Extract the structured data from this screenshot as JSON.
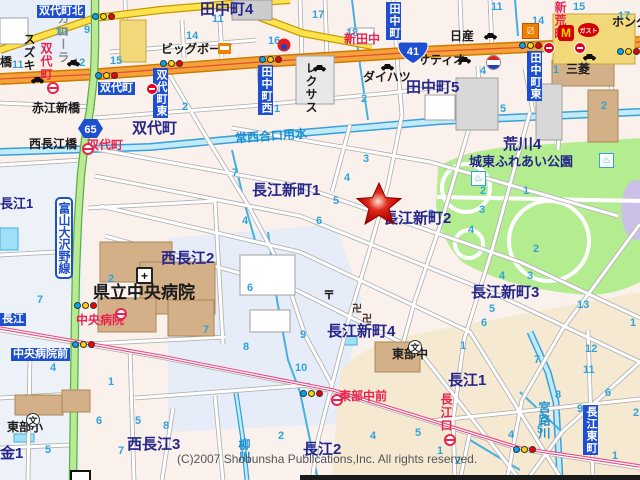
{
  "map": {
    "copyright": "(C)2007 Shobunsha Publications,Inc. All rights reserved.",
    "road_name_plate": "富山大沢野線",
    "route_shields": [
      {
        "number": "65",
        "type": "prefectural-road-hexagon"
      },
      {
        "number": "41",
        "type": "national-route-cartouche"
      }
    ],
    "marker": {
      "name": "destination-star",
      "color": "#cc1111"
    },
    "colors": {
      "district_label": "#26268a",
      "sign_blue": "#1e4fd0",
      "bus_red": "#e8244f",
      "water_blue": "#1d8fd0",
      "block_number": "#2fa3dc",
      "road_national": "#f6a23c",
      "road_pref": "#b9ea96",
      "road_minor_yellow": "#ffe34d",
      "park": "#b4ec90",
      "tram": "#e8487f"
    },
    "glyphs": {
      "school": "文",
      "post_office": "〒",
      "temple": "卍",
      "onsen": "♨",
      "mcdonalds": "M",
      "gusto_text": "ガスト"
    },
    "labels": {
      "districts": [
        {
          "t": "田中町4",
          "x": 200,
          "y": 2,
          "big": 1
        },
        {
          "t": "田中町5",
          "x": 406,
          "y": 80,
          "big": 1
        },
        {
          "t": "双代町",
          "x": 132,
          "y": 121,
          "big": 1
        },
        {
          "t": "荒川4",
          "x": 503,
          "y": 137,
          "big": 1
        },
        {
          "t": "城東ふれあい公園",
          "x": 469,
          "y": 155
        },
        {
          "t": "長江新町1",
          "x": 252,
          "y": 183,
          "big": 1
        },
        {
          "t": "長江新町2",
          "x": 383,
          "y": 211,
          "big": 1
        },
        {
          "t": "長江新町3",
          "x": 471,
          "y": 285,
          "big": 1
        },
        {
          "t": "長江新町4",
          "x": 327,
          "y": 324,
          "big": 1
        },
        {
          "t": "長江1",
          "x": 448,
          "y": 373,
          "big": 1
        },
        {
          "t": "長江1",
          "x": 0,
          "y": 197
        },
        {
          "t": "長江2",
          "x": 303,
          "y": 442,
          "big": 1
        },
        {
          "t": "西長江2",
          "x": 161,
          "y": 251,
          "big": 1
        },
        {
          "t": "西長江3",
          "x": 127,
          "y": 437,
          "big": 1
        },
        {
          "t": "金1",
          "x": 0,
          "y": 446,
          "big": 1
        }
      ],
      "blue_signs": [
        {
          "t": "双代町北",
          "x": 37,
          "y": 5
        },
        {
          "t": "双代町",
          "x": 98,
          "y": 82
        },
        {
          "t": "中央病院前",
          "x": 11,
          "y": 348
        },
        {
          "t": "長江",
          "x": 0,
          "y": 313
        },
        {
          "t": "双代町東",
          "x": 153,
          "y": 68,
          "v": 1
        },
        {
          "t": "田中町西",
          "x": 258,
          "y": 65,
          "v": 1
        },
        {
          "t": "田中町",
          "x": 386,
          "y": 2,
          "v": 1
        },
        {
          "t": "田中町東",
          "x": 527,
          "y": 51,
          "v": 1
        },
        {
          "t": "長江東町",
          "x": 583,
          "y": 405,
          "v": 1
        }
      ],
      "red_stops": [
        {
          "t": "新田中",
          "x": 344,
          "y": 33
        },
        {
          "t": "新荒町",
          "x": 554,
          "y": 1,
          "v": 1
        },
        {
          "t": "双代町",
          "x": 40,
          "y": 42,
          "v": 1
        },
        {
          "t": "双代町",
          "x": 87,
          "y": 139
        },
        {
          "t": "中央病院",
          "x": 76,
          "y": 314
        },
        {
          "t": "東部中前",
          "x": 339,
          "y": 390
        },
        {
          "t": "長江口",
          "x": 440,
          "y": 393,
          "v": 1
        }
      ],
      "facilities": [
        {
          "t": "スズキ",
          "x": 23,
          "y": 33,
          "v": 1
        },
        {
          "t": "カローラ",
          "x": 57,
          "y": 12,
          "v": 1,
          "gray": 1
        },
        {
          "t": "橋",
          "x": 0,
          "y": 56
        },
        {
          "t": "赤江新橋",
          "x": 32,
          "y": 102
        },
        {
          "t": "西長江橋",
          "x": 29,
          "y": 138
        },
        {
          "t": "ビッグボーイ",
          "x": 161,
          "y": 43
        },
        {
          "t": "レクサス",
          "x": 305,
          "y": 62,
          "v": 1
        },
        {
          "t": "ダイハツ",
          "x": 363,
          "y": 71
        },
        {
          "t": "日産",
          "x": 450,
          "y": 30
        },
        {
          "t": "サティオ",
          "x": 418,
          "y": 54
        },
        {
          "t": "三菱",
          "x": 566,
          "y": 63
        },
        {
          "t": "ホンダ",
          "x": 612,
          "y": 16
        },
        {
          "t": "県立中央病院",
          "x": 93,
          "y": 284,
          "big": 1
        },
        {
          "t": "東部小",
          "x": 7,
          "y": 421
        },
        {
          "t": "東部中",
          "x": 392,
          "y": 348
        }
      ],
      "water": [
        {
          "t": "常西合口用水",
          "x": 235,
          "y": 130,
          "rot": -4
        },
        {
          "t": "宮路川",
          "x": 538,
          "y": 401,
          "v": 1
        },
        {
          "t": "柳川",
          "x": 238,
          "y": 438,
          "v": 1
        }
      ],
      "block_numbers": [
        {
          "t": "10",
          "x": 55,
          "y": 27
        },
        {
          "t": "9",
          "x": 84,
          "y": 25
        },
        {
          "t": "11",
          "x": 12,
          "y": 60
        },
        {
          "t": "12",
          "x": 73,
          "y": 58
        },
        {
          "t": "15",
          "x": 110,
          "y": 56
        },
        {
          "t": "14",
          "x": 186,
          "y": 31
        },
        {
          "t": "2",
          "x": 182,
          "y": 102
        },
        {
          "t": "11",
          "x": 212,
          "y": 14
        },
        {
          "t": "16",
          "x": 268,
          "y": 36
        },
        {
          "t": "17",
          "x": 312,
          "y": 10
        },
        {
          "t": "18",
          "x": 346,
          "y": 28
        },
        {
          "t": "2",
          "x": 361,
          "y": 94
        },
        {
          "t": "1",
          "x": 274,
          "y": 104
        },
        {
          "t": "11",
          "x": 491,
          "y": 2
        },
        {
          "t": "14",
          "x": 532,
          "y": 16
        },
        {
          "t": "15",
          "x": 573,
          "y": 2
        },
        {
          "t": "17",
          "x": 618,
          "y": 11
        },
        {
          "t": "4",
          "x": 480,
          "y": 66
        },
        {
          "t": "5",
          "x": 500,
          "y": 104
        },
        {
          "t": "1",
          "x": 553,
          "y": 65
        },
        {
          "t": "2",
          "x": 601,
          "y": 101
        },
        {
          "t": "7",
          "x": 232,
          "y": 168
        },
        {
          "t": "3",
          "x": 363,
          "y": 154
        },
        {
          "t": "4",
          "x": 344,
          "y": 173
        },
        {
          "t": "5",
          "x": 333,
          "y": 196
        },
        {
          "t": "6",
          "x": 316,
          "y": 216
        },
        {
          "t": "4",
          "x": 242,
          "y": 216
        },
        {
          "t": "2",
          "x": 428,
          "y": 209
        },
        {
          "t": "2",
          "x": 480,
          "y": 186
        },
        {
          "t": "1",
          "x": 523,
          "y": 186
        },
        {
          "t": "3",
          "x": 479,
          "y": 205
        },
        {
          "t": "4",
          "x": 468,
          "y": 225
        },
        {
          "t": "2",
          "x": 108,
          "y": 274
        },
        {
          "t": "7",
          "x": 37,
          "y": 295
        },
        {
          "t": "1",
          "x": 108,
          "y": 377
        },
        {
          "t": "4",
          "x": 50,
          "y": 363
        },
        {
          "t": "6",
          "x": 247,
          "y": 283
        },
        {
          "t": "7",
          "x": 203,
          "y": 325
        },
        {
          "t": "8",
          "x": 243,
          "y": 342
        },
        {
          "t": "9",
          "x": 300,
          "y": 330
        },
        {
          "t": "10",
          "x": 295,
          "y": 363
        },
        {
          "t": "2",
          "x": 533,
          "y": 244
        },
        {
          "t": "4",
          "x": 499,
          "y": 271
        },
        {
          "t": "3",
          "x": 527,
          "y": 271
        },
        {
          "t": "13",
          "x": 577,
          "y": 300
        },
        {
          "t": "5",
          "x": 489,
          "y": 304
        },
        {
          "t": "6",
          "x": 481,
          "y": 318
        },
        {
          "t": "12",
          "x": 585,
          "y": 344
        },
        {
          "t": "7",
          "x": 534,
          "y": 355
        },
        {
          "t": "11",
          "x": 583,
          "y": 365
        },
        {
          "t": "1",
          "x": 460,
          "y": 341
        },
        {
          "t": "1",
          "x": 630,
          "y": 318
        },
        {
          "t": "8",
          "x": 555,
          "y": 390
        },
        {
          "t": "9",
          "x": 577,
          "y": 404
        },
        {
          "t": "4",
          "x": 508,
          "y": 430
        },
        {
          "t": "5",
          "x": 537,
          "y": 425
        },
        {
          "t": "2",
          "x": 455,
          "y": 456
        },
        {
          "t": "6",
          "x": 96,
          "y": 416
        },
        {
          "t": "5",
          "x": 135,
          "y": 416
        },
        {
          "t": "7",
          "x": 118,
          "y": 446
        },
        {
          "t": "5",
          "x": 45,
          "y": 445
        },
        {
          "t": "8",
          "x": 163,
          "y": 421
        },
        {
          "t": "2",
          "x": 278,
          "y": 431
        },
        {
          "t": "4",
          "x": 370,
          "y": 431
        },
        {
          "t": "5",
          "x": 415,
          "y": 428
        },
        {
          "t": "1",
          "x": 437,
          "y": 446
        },
        {
          "t": "6",
          "x": 605,
          "y": 388
        },
        {
          "t": "2",
          "x": 633,
          "y": 408
        },
        {
          "t": "1",
          "x": 612,
          "y": 451
        }
      ]
    },
    "icons": [
      {
        "type": "traffic-signal",
        "x": 92,
        "y": 13
      },
      {
        "type": "traffic-signal",
        "x": 95,
        "y": 72
      },
      {
        "type": "traffic-signal",
        "x": 160,
        "y": 60
      },
      {
        "type": "traffic-signal",
        "x": 259,
        "y": 56
      },
      {
        "type": "traffic-signal",
        "x": 519,
        "y": 42
      },
      {
        "type": "traffic-signal",
        "x": 617,
        "y": 48
      },
      {
        "type": "traffic-signal",
        "x": 74,
        "y": 302
      },
      {
        "type": "traffic-signal",
        "x": 72,
        "y": 341
      },
      {
        "type": "traffic-signal",
        "x": 300,
        "y": 390
      },
      {
        "type": "traffic-signal",
        "x": 513,
        "y": 446
      },
      {
        "type": "bus-stop",
        "x": 47,
        "y": 82
      },
      {
        "type": "bus-stop",
        "x": 82,
        "y": 143
      },
      {
        "type": "bus-stop",
        "x": 115,
        "y": 308
      },
      {
        "type": "bus-stop",
        "x": 331,
        "y": 394
      },
      {
        "type": "bus-stop",
        "x": 444,
        "y": 434
      },
      {
        "type": "no-entry-sign",
        "x": 146,
        "y": 83
      },
      {
        "type": "no-entry-sign",
        "x": 543,
        "y": 42
      },
      {
        "type": "no-entry-sign",
        "x": 574,
        "y": 42
      },
      {
        "type": "car-dealer",
        "x": 30,
        "y": 76
      },
      {
        "type": "car-dealer",
        "x": 66,
        "y": 59
      },
      {
        "type": "car-dealer",
        "x": 312,
        "y": 64
      },
      {
        "type": "car-dealer",
        "x": 380,
        "y": 63
      },
      {
        "type": "car-dealer",
        "x": 483,
        "y": 32
      },
      {
        "type": "car-dealer",
        "x": 457,
        "y": 56
      },
      {
        "type": "car-dealer",
        "x": 582,
        "y": 53
      },
      {
        "type": "school",
        "x": 26,
        "y": 413
      },
      {
        "type": "school",
        "x": 408,
        "y": 340
      },
      {
        "type": "hospital",
        "x": 136,
        "y": 267
      },
      {
        "type": "post-office",
        "x": 323,
        "y": 286
      },
      {
        "type": "temple",
        "x": 352,
        "y": 300
      },
      {
        "type": "temple",
        "x": 362,
        "y": 310
      },
      {
        "type": "onsen",
        "x": 471,
        "y": 171
      },
      {
        "type": "onsen",
        "x": 599,
        "y": 153
      },
      {
        "type": "mcdonalds",
        "x": 558,
        "y": 25
      },
      {
        "type": "gusto-restaurant",
        "x": 578,
        "y": 23
      },
      {
        "type": "shop-logo",
        "x": 522,
        "y": 23
      },
      {
        "type": "convenience-store",
        "x": 218,
        "y": 43
      },
      {
        "type": "store-logo-red",
        "x": 277,
        "y": 38
      },
      {
        "type": "gas-station",
        "x": 486,
        "y": 55
      },
      {
        "type": "bridge",
        "x": 70,
        "y": 470
      }
    ]
  }
}
